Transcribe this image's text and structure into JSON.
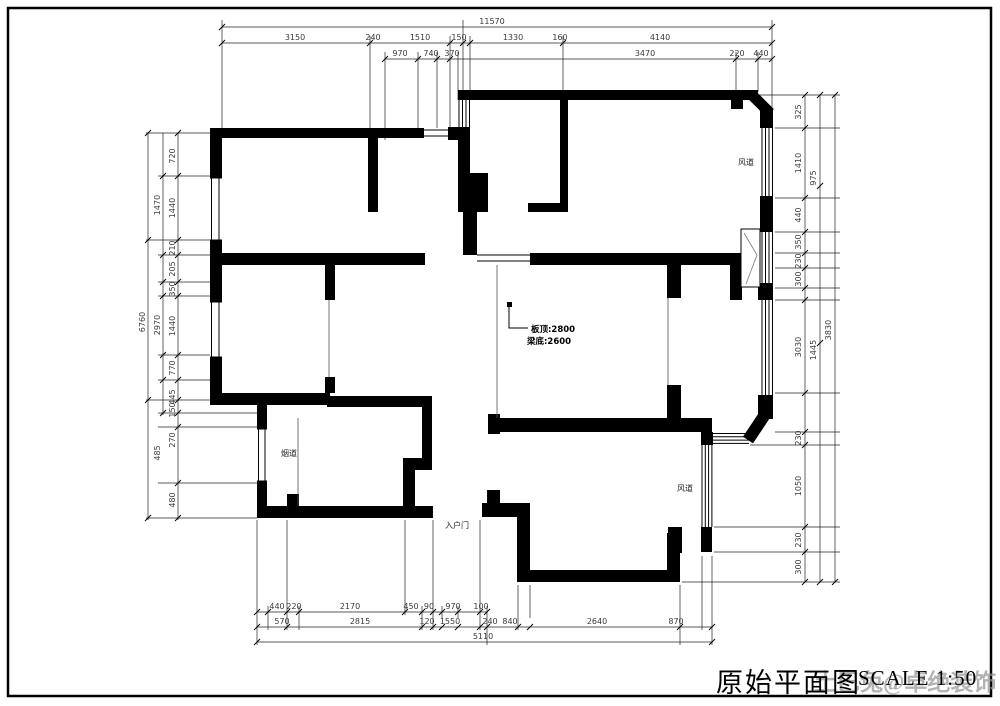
{
  "drawing": {
    "title": "原始平面图",
    "scale_label": "SCALE 1:50",
    "watermark": "土巴兔@卓绝装饰"
  },
  "note": {
    "line1": "板顶:2800",
    "line2": "梁底:2600"
  },
  "plan_labels": [
    {
      "t": "风道",
      "x": 746,
      "y": 165,
      "s": 8
    },
    {
      "t": "风道",
      "x": 685,
      "y": 491,
      "s": 8
    },
    {
      "t": "烟道",
      "x": 289,
      "y": 456,
      "s": 7
    },
    {
      "t": "入户门",
      "x": 457,
      "y": 528,
      "s": 7
    }
  ],
  "dims": {
    "top": [
      {
        "t": "11570",
        "x": 492,
        "y": 24
      },
      {
        "t": "3150",
        "x": 295,
        "y": 40
      },
      {
        "t": "240",
        "x": 373,
        "y": 40
      },
      {
        "t": "1510",
        "x": 420,
        "y": 40
      },
      {
        "t": "150",
        "x": 459,
        "y": 40
      },
      {
        "t": "1330",
        "x": 513,
        "y": 40
      },
      {
        "t": "160",
        "x": 560,
        "y": 40
      },
      {
        "t": "4140",
        "x": 660,
        "y": 40
      },
      {
        "t": "970",
        "x": 400,
        "y": 56
      },
      {
        "t": "740",
        "x": 431,
        "y": 56
      },
      {
        "t": "370",
        "x": 452,
        "y": 56
      },
      {
        "t": "3470",
        "x": 645,
        "y": 56
      },
      {
        "t": "220",
        "x": 737,
        "y": 56
      },
      {
        "t": "440",
        "x": 761,
        "y": 56
      }
    ],
    "left": [
      {
        "t": "6760",
        "x": 145,
        "y": 322,
        "r": -90
      },
      {
        "t": "1470",
        "x": 160,
        "y": 205,
        "r": -90
      },
      {
        "t": "2970",
        "x": 160,
        "y": 325,
        "r": -90
      },
      {
        "t": "485",
        "x": 160,
        "y": 453,
        "r": -90
      },
      {
        "t": "720",
        "x": 175,
        "y": 156,
        "r": -90
      },
      {
        "t": "1440",
        "x": 175,
        "y": 208,
        "r": -90
      },
      {
        "t": "210",
        "x": 175,
        "y": 248,
        "r": -90
      },
      {
        "t": "205",
        "x": 175,
        "y": 269,
        "r": -90
      },
      {
        "t": "350",
        "x": 175,
        "y": 289,
        "r": -90
      },
      {
        "t": "1440",
        "x": 175,
        "y": 326,
        "r": -90
      },
      {
        "t": "770",
        "x": 175,
        "y": 368,
        "r": -90
      },
      {
        "t": "445",
        "x": 175,
        "y": 397,
        "r": -90
      },
      {
        "t": "150",
        "x": 175,
        "y": 410,
        "r": -90
      },
      {
        "t": "270",
        "x": 175,
        "y": 440,
        "r": -90
      },
      {
        "t": "480",
        "x": 175,
        "y": 500,
        "r": -90
      }
    ],
    "right": [
      {
        "t": "325",
        "x": 801,
        "y": 112,
        "r": -90
      },
      {
        "t": "1410",
        "x": 801,
        "y": 163,
        "r": -90
      },
      {
        "t": "440",
        "x": 801,
        "y": 215,
        "r": -90
      },
      {
        "t": "350",
        "x": 801,
        "y": 242,
        "r": -90
      },
      {
        "t": "230",
        "x": 801,
        "y": 261,
        "r": -90
      },
      {
        "t": "300",
        "x": 801,
        "y": 279,
        "r": -90
      },
      {
        "t": "3030",
        "x": 801,
        "y": 347,
        "r": -90
      },
      {
        "t": "230",
        "x": 801,
        "y": 438,
        "r": -90
      },
      {
        "t": "1050",
        "x": 801,
        "y": 486,
        "r": -90
      },
      {
        "t": "230",
        "x": 801,
        "y": 540,
        "r": -90
      },
      {
        "t": "300",
        "x": 801,
        "y": 567,
        "r": -90
      },
      {
        "t": "975",
        "x": 816,
        "y": 178,
        "r": -90
      },
      {
        "t": "1445",
        "x": 816,
        "y": 350,
        "r": -90
      },
      {
        "t": "3830",
        "x": 831,
        "y": 330,
        "r": -90
      }
    ],
    "bottom": [
      {
        "t": "440",
        "x": 277,
        "y": 609
      },
      {
        "t": "220",
        "x": 294,
        "y": 609
      },
      {
        "t": "2170",
        "x": 350,
        "y": 609
      },
      {
        "t": "450",
        "x": 411,
        "y": 609
      },
      {
        "t": "90",
        "x": 429,
        "y": 609
      },
      {
        "t": "970",
        "x": 453,
        "y": 609
      },
      {
        "t": "100",
        "x": 481,
        "y": 609
      },
      {
        "t": "570",
        "x": 282,
        "y": 624
      },
      {
        "t": "2815",
        "x": 360,
        "y": 624
      },
      {
        "t": "120",
        "x": 427,
        "y": 624
      },
      {
        "t": "1550",
        "x": 450,
        "y": 624
      },
      {
        "t": "240",
        "x": 490,
        "y": 624
      },
      {
        "t": "840",
        "x": 510,
        "y": 624
      },
      {
        "t": "2640",
        "x": 597,
        "y": 624
      },
      {
        "t": "870",
        "x": 676,
        "y": 624
      },
      {
        "t": "5110",
        "x": 483,
        "y": 639
      }
    ]
  },
  "colors": {
    "ink": "#000000",
    "dim_text": "#3a3a3a",
    "watermark": "#979797"
  }
}
